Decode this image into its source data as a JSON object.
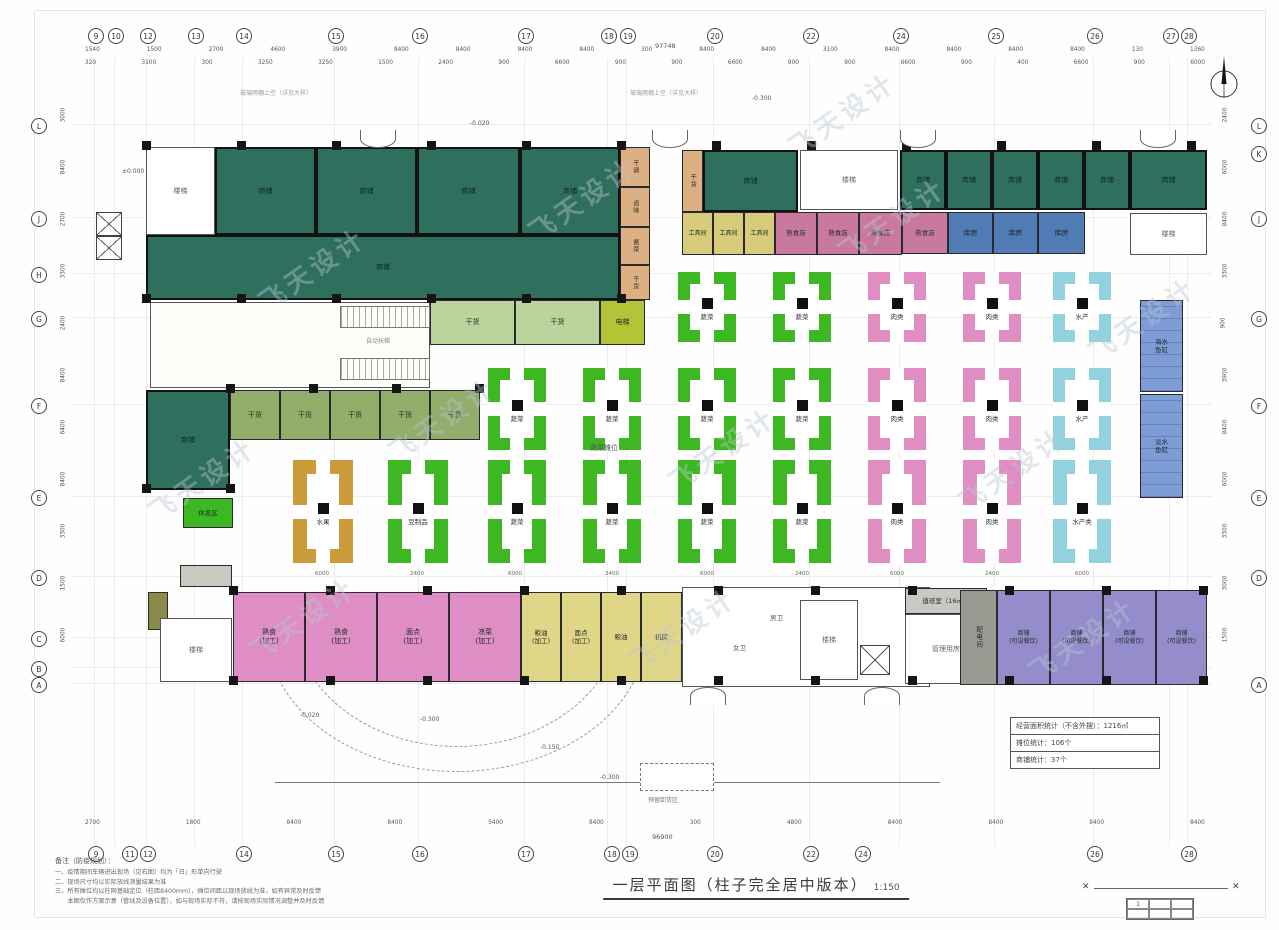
{
  "title": {
    "text": "一层平面图（柱子完全居中版本）",
    "scale": "1:150"
  },
  "watermark": {
    "text": "飞天设计",
    "spots": [
      [
        250,
        250
      ],
      [
        520,
        180
      ],
      [
        830,
        200
      ],
      [
        1080,
        300
      ],
      [
        380,
        400
      ],
      [
        660,
        430
      ],
      [
        950,
        450
      ],
      [
        240,
        600
      ],
      [
        620,
        610
      ],
      [
        1020,
        620
      ],
      [
        780,
        95
      ],
      [
        140,
        460
      ]
    ]
  },
  "notes": {
    "heading": "备注（防疫规划）：",
    "items": [
      "一、疫情期间车辆进出现场（见右图）均为「日」形单向行驶",
      "二、现场尺寸均以实际放线测量结果为准",
      "三、所有摊位均以柱网基础定位（柱距8400mm），摊位间距以现场放线为准，如有异常及时反馈",
      "　　本图仅作方案示意（管线及设备位置），如与现场实际不符，请按现场实际情况调整并及时反馈"
    ]
  },
  "stats_box": {
    "rows": [
      "经营面积统计（不含外摆）：1216㎡",
      "摊位统计：106个",
      "商铺统计：37个"
    ]
  },
  "title_block": {
    "mark": "✕",
    "cells": [
      "1",
      "",
      "",
      "",
      "",
      ""
    ]
  },
  "compass": {
    "label": "北"
  },
  "colors": {
    "teal": "#2e6f5e",
    "green": "#3eb822",
    "pink": "#e08ec2",
    "cyan": "#92d2de",
    "orange": "#cc9b3c",
    "tan": "#ddb083",
    "lgreen": "#b9d49c",
    "mgreen": "#93ad6b",
    "ygreen": "#b3c437",
    "yellowm": "#d6cc7c",
    "yellowb": "#e0d688",
    "pinkm": "#c9799e",
    "pinkb": "#de8ec4",
    "blue": "#4f7cb5",
    "bluestrip": "#7e9cd6",
    "purple": "#958dcb",
    "grey": "#9a9a92",
    "greyl": "#c9c9c2",
    "olive": "#8a8a4a",
    "stair": "#ffffff",
    "atrium": "#fdfdfa",
    "wc": "#ffffff",
    "white": "#ffffff"
  },
  "axes": {
    "top_bubbles": [
      [
        "9",
        88
      ],
      [
        "10",
        108
      ],
      [
        "12",
        140
      ],
      [
        "13",
        188
      ],
      [
        "14",
        236
      ],
      [
        "15",
        328
      ],
      [
        "16",
        412
      ],
      [
        "17",
        518
      ],
      [
        "18",
        601
      ],
      [
        "19",
        620
      ],
      [
        "20",
        707
      ],
      [
        "22",
        803
      ],
      [
        "24",
        893
      ],
      [
        "25",
        988
      ],
      [
        "26",
        1087
      ],
      [
        "27",
        1163
      ],
      [
        "28",
        1181
      ]
    ],
    "bottom_bubbles": [
      [
        "9",
        88
      ],
      [
        "11",
        122
      ],
      [
        "12",
        140
      ],
      [
        "14",
        236
      ],
      [
        "15",
        328
      ],
      [
        "16",
        412
      ],
      [
        "17",
        518
      ],
      [
        "18",
        604
      ],
      [
        "19",
        622
      ],
      [
        "20",
        707
      ],
      [
        "22",
        803
      ],
      [
        "24",
        855
      ],
      [
        "26",
        1087
      ],
      [
        "28",
        1181
      ]
    ],
    "left_letters": [
      [
        "L",
        118
      ],
      [
        "J",
        211
      ],
      [
        "H",
        267
      ],
      [
        "G",
        311
      ],
      [
        "F",
        398
      ],
      [
        "E",
        490
      ],
      [
        "D",
        570
      ],
      [
        "C",
        631
      ],
      [
        "B",
        661
      ],
      [
        "A",
        677
      ]
    ],
    "right_letters": [
      [
        "L",
        118
      ],
      [
        "K",
        146
      ],
      [
        "J",
        211
      ],
      [
        "G",
        311
      ],
      [
        "F",
        398
      ],
      [
        "E",
        490
      ],
      [
        "D",
        570
      ],
      [
        "A",
        677
      ]
    ]
  },
  "dims": {
    "top1": [
      "1540",
      "1500",
      "2700",
      "4600",
      "3900",
      "8400",
      "8400",
      "8400",
      "8400",
      "300",
      "8400",
      "8400",
      "3100",
      "8400",
      "8400",
      "8400",
      "8400",
      "130",
      "1360"
    ],
    "top2": [
      "320",
      "3100",
      "300",
      "3250",
      "3250",
      "1500",
      "2400",
      "900",
      "6600",
      "900",
      "900",
      "6600",
      "900",
      "900",
      "6600",
      "900",
      "400",
      "6600",
      "900",
      "6000"
    ],
    "bottom": [
      "2700",
      "1800",
      "8400",
      "8400",
      "5400",
      "8400",
      "300",
      "4800",
      "8400",
      "8400",
      "8400",
      "8400"
    ],
    "left": [
      "3000",
      "8400",
      "2700",
      "3300",
      "2400",
      "8400",
      "6400",
      "8400",
      "3300",
      "1500",
      "6000"
    ],
    "right": [
      "2400",
      "6000",
      "8400",
      "3300",
      "900",
      "3900",
      "8400",
      "6000",
      "3300",
      "3000",
      "1500"
    ],
    "top_total": "97748",
    "bottom_total": "96900"
  },
  "columns": [
    {
      "y": 145,
      "x0": 146,
      "x1": 1206,
      "step": 95
    },
    {
      "y": 298,
      "x0": 146,
      "x1": 646,
      "step": 95
    },
    {
      "y": 388,
      "x0": 230,
      "x1": 480,
      "step": 83
    },
    {
      "y": 488,
      "x0": 146,
      "x1": 231,
      "step": 84
    },
    {
      "y": 590,
      "x0": 233,
      "x1": 1205,
      "step": 97
    },
    {
      "y": 680,
      "x0": 233,
      "x1": 1205,
      "step": 97
    }
  ],
  "rooms": [
    {
      "x": 146,
      "y": 147,
      "w": 69,
      "h": 88,
      "c": "stair",
      "t": "楼梯"
    },
    {
      "x": 215,
      "y": 147,
      "w": 101,
      "h": 88,
      "c": "teal",
      "t": "商铺"
    },
    {
      "x": 316,
      "y": 147,
      "w": 101,
      "h": 88,
      "c": "teal",
      "t": "商铺"
    },
    {
      "x": 417,
      "y": 147,
      "w": 103,
      "h": 88,
      "c": "teal",
      "t": "商铺"
    },
    {
      "x": 520,
      "y": 147,
      "w": 100,
      "h": 88,
      "c": "teal",
      "t": "商铺"
    },
    {
      "x": 146,
      "y": 235,
      "w": 474,
      "h": 65,
      "c": "teal",
      "t": "商铺"
    },
    {
      "x": 620,
      "y": 147,
      "w": 30,
      "h": 40,
      "c": "tan",
      "t": "干调",
      "v": 1,
      "fs": 6
    },
    {
      "x": 620,
      "y": 187,
      "w": 30,
      "h": 40,
      "c": "tan",
      "t": "卤味",
      "v": 1,
      "fs": 6
    },
    {
      "x": 620,
      "y": 227,
      "w": 30,
      "h": 38,
      "c": "tan",
      "t": "酱菜",
      "v": 1,
      "fs": 6
    },
    {
      "x": 620,
      "y": 265,
      "w": 30,
      "h": 35,
      "c": "tan",
      "t": "干货",
      "v": 1,
      "fs": 6
    },
    {
      "x": 682,
      "y": 150,
      "w": 21,
      "h": 62,
      "c": "tan",
      "t": "干货",
      "v": 1,
      "fs": 6
    },
    {
      "x": 703,
      "y": 150,
      "w": 95,
      "h": 62,
      "c": "teal",
      "t": "商铺"
    },
    {
      "x": 800,
      "y": 150,
      "w": 98,
      "h": 60,
      "c": "stair",
      "t": "楼梯"
    },
    {
      "x": 900,
      "y": 150,
      "w": 46,
      "h": 60,
      "c": "teal",
      "t": "商铺"
    },
    {
      "x": 946,
      "y": 150,
      "w": 46,
      "h": 60,
      "c": "teal",
      "t": "商铺"
    },
    {
      "x": 992,
      "y": 150,
      "w": 46,
      "h": 60,
      "c": "teal",
      "t": "商铺"
    },
    {
      "x": 1038,
      "y": 150,
      "w": 46,
      "h": 60,
      "c": "teal",
      "t": "商铺"
    },
    {
      "x": 1084,
      "y": 150,
      "w": 46,
      "h": 60,
      "c": "teal",
      "t": "商铺"
    },
    {
      "x": 1130,
      "y": 150,
      "w": 77,
      "h": 60,
      "c": "teal",
      "t": "商铺"
    },
    {
      "x": 682,
      "y": 212,
      "w": 31,
      "h": 43,
      "c": "yellowm",
      "t": "工具间",
      "fs": 6
    },
    {
      "x": 713,
      "y": 212,
      "w": 31,
      "h": 43,
      "c": "yellowm",
      "t": "工具间",
      "fs": 6
    },
    {
      "x": 744,
      "y": 212,
      "w": 31,
      "h": 43,
      "c": "yellowm",
      "t": "工具间",
      "fs": 6
    },
    {
      "x": 775,
      "y": 212,
      "w": 42,
      "h": 43,
      "c": "pinkm",
      "t": "熟食店",
      "fs": 6.5
    },
    {
      "x": 817,
      "y": 212,
      "w": 42,
      "h": 43,
      "c": "pinkm",
      "t": "熟食店",
      "fs": 6.5
    },
    {
      "x": 859,
      "y": 212,
      "w": 43,
      "h": 43,
      "c": "pinkm",
      "t": "熟食店",
      "fs": 6.5
    },
    {
      "x": 902,
      "y": 212,
      "w": 46,
      "h": 42,
      "c": "pinkm",
      "t": "熟食店",
      "fs": 6.5
    },
    {
      "x": 948,
      "y": 212,
      "w": 45,
      "h": 42,
      "c": "blue",
      "t": "库房"
    },
    {
      "x": 993,
      "y": 212,
      "w": 45,
      "h": 42,
      "c": "blue",
      "t": "库房"
    },
    {
      "x": 1038,
      "y": 212,
      "w": 47,
      "h": 42,
      "c": "blue",
      "t": "库房"
    },
    {
      "x": 1130,
      "y": 213,
      "w": 77,
      "h": 42,
      "c": "stair",
      "t": "楼梯"
    },
    {
      "x": 150,
      "y": 302,
      "w": 280,
      "h": 86,
      "c": "atrium",
      "t": ""
    },
    {
      "x": 430,
      "y": 300,
      "w": 85,
      "h": 45,
      "c": "lgreen",
      "t": "干货"
    },
    {
      "x": 515,
      "y": 300,
      "w": 85,
      "h": 45,
      "c": "lgreen",
      "t": "干货"
    },
    {
      "x": 600,
      "y": 300,
      "w": 45,
      "h": 45,
      "c": "ygreen",
      "t": "电梯"
    },
    {
      "x": 146,
      "y": 390,
      "w": 84,
      "h": 100,
      "c": "teal",
      "t": "商铺"
    },
    {
      "x": 230,
      "y": 390,
      "w": 50,
      "h": 50,
      "c": "mgreen",
      "t": "干货"
    },
    {
      "x": 280,
      "y": 390,
      "w": 50,
      "h": 50,
      "c": "mgreen",
      "t": "干货"
    },
    {
      "x": 330,
      "y": 390,
      "w": 50,
      "h": 50,
      "c": "mgreen",
      "t": "干货"
    },
    {
      "x": 380,
      "y": 390,
      "w": 50,
      "h": 50,
      "c": "mgreen",
      "t": "干货"
    },
    {
      "x": 430,
      "y": 390,
      "w": 50,
      "h": 50,
      "c": "mgreen",
      "t": "干货"
    },
    {
      "x": 183,
      "y": 498,
      "w": 50,
      "h": 30,
      "c": "green",
      "t": "休息区",
      "fs": 6.5
    },
    {
      "x": 1140,
      "y": 300,
      "w": 43,
      "h": 92,
      "c": "bluestrip",
      "t": "海水\n鱼缸",
      "fs": 6.5
    },
    {
      "x": 1140,
      "y": 394,
      "w": 43,
      "h": 104,
      "c": "bluestrip",
      "t": "淡水\n鱼缸",
      "fs": 6.5
    },
    {
      "x": 180,
      "y": 565,
      "w": 52,
      "h": 22,
      "c": "greyl",
      "t": ""
    },
    {
      "x": 148,
      "y": 592,
      "w": 20,
      "h": 38,
      "c": "olive",
      "t": ""
    },
    {
      "x": 160,
      "y": 618,
      "w": 72,
      "h": 64,
      "c": "stair",
      "t": "楼梯"
    },
    {
      "x": 233,
      "y": 592,
      "w": 72,
      "h": 90,
      "c": "pinkb",
      "t": "熟食\n(加工)"
    },
    {
      "x": 305,
      "y": 592,
      "w": 72,
      "h": 90,
      "c": "pinkb",
      "t": "熟食\n(加工)"
    },
    {
      "x": 377,
      "y": 592,
      "w": 72,
      "h": 90,
      "c": "pinkb",
      "t": "面点\n(加工)"
    },
    {
      "x": 449,
      "y": 592,
      "w": 72,
      "h": 90,
      "c": "pinkb",
      "t": "凉菜\n(加工)"
    },
    {
      "x": 521,
      "y": 592,
      "w": 40,
      "h": 90,
      "c": "yellowb",
      "t": "粮油\n(加工)",
      "fs": 6.5
    },
    {
      "x": 561,
      "y": 592,
      "w": 40,
      "h": 90,
      "c": "yellowb",
      "t": "面点\n(加工)",
      "fs": 6.5
    },
    {
      "x": 601,
      "y": 592,
      "w": 40,
      "h": 90,
      "c": "yellowb",
      "t": "粮油",
      "fs": 6.5
    },
    {
      "x": 641,
      "y": 592,
      "w": 41,
      "h": 90,
      "c": "yellowb",
      "t": "机房",
      "fs": 6.5
    },
    {
      "x": 682,
      "y": 587,
      "w": 248,
      "h": 100,
      "c": "wc",
      "t": ""
    },
    {
      "x": 800,
      "y": 600,
      "w": 58,
      "h": 80,
      "c": "stair",
      "t": "楼梯"
    },
    {
      "x": 905,
      "y": 588,
      "w": 82,
      "h": 26,
      "c": "greyl",
      "t": "值班室（16㎡）",
      "fs": 6.5
    },
    {
      "x": 905,
      "y": 614,
      "w": 82,
      "h": 70,
      "c": "white",
      "t": "管理用房"
    },
    {
      "x": 960,
      "y": 590,
      "w": 37,
      "h": 95,
      "c": "grey",
      "t": "配电间",
      "v": 1,
      "fs": 6.5
    },
    {
      "x": 997,
      "y": 590,
      "w": 53,
      "h": 95,
      "c": "purple",
      "t": "商铺\n(可设餐饮)",
      "fs": 6
    },
    {
      "x": 1050,
      "y": 590,
      "w": 53,
      "h": 95,
      "c": "purple",
      "t": "商铺\n(可设餐饮)",
      "fs": 6
    },
    {
      "x": 1103,
      "y": 590,
      "w": 53,
      "h": 95,
      "c": "purple",
      "t": "商铺\n(可设餐饮)",
      "fs": 6
    },
    {
      "x": 1156,
      "y": 590,
      "w": 51,
      "h": 95,
      "c": "purple",
      "t": "商铺\n(可设餐饮)",
      "fs": 6
    }
  ],
  "stalls": [
    {
      "x": 678,
      "y": 272,
      "w": 58,
      "h": 70,
      "c": "green",
      "t": "蔬菜"
    },
    {
      "x": 773,
      "y": 272,
      "w": 58,
      "h": 70,
      "c": "green",
      "t": "蔬菜"
    },
    {
      "x": 868,
      "y": 272,
      "w": 58,
      "h": 70,
      "c": "pink",
      "t": "肉类"
    },
    {
      "x": 963,
      "y": 272,
      "w": 58,
      "h": 70,
      "c": "pink",
      "t": "肉类"
    },
    {
      "x": 1053,
      "y": 272,
      "w": 58,
      "h": 70,
      "c": "cyan",
      "t": "水产"
    },
    {
      "x": 488,
      "y": 368,
      "w": 58,
      "h": 82,
      "c": "green",
      "t": "蔬菜"
    },
    {
      "x": 583,
      "y": 368,
      "w": 58,
      "h": 82,
      "c": "green",
      "t": "蔬菜"
    },
    {
      "x": 678,
      "y": 368,
      "w": 58,
      "h": 82,
      "c": "green",
      "t": "蔬菜"
    },
    {
      "x": 773,
      "y": 368,
      "w": 58,
      "h": 82,
      "c": "green",
      "t": "蔬菜"
    },
    {
      "x": 868,
      "y": 368,
      "w": 58,
      "h": 82,
      "c": "pink",
      "t": "肉类"
    },
    {
      "x": 963,
      "y": 368,
      "w": 58,
      "h": 82,
      "c": "pink",
      "t": "肉类"
    },
    {
      "x": 1053,
      "y": 368,
      "w": 58,
      "h": 82,
      "c": "cyan",
      "t": "水产"
    },
    {
      "x": 293,
      "y": 460,
      "w": 60,
      "h": 103,
      "c": "orange",
      "t": "水果"
    },
    {
      "x": 388,
      "y": 460,
      "w": 60,
      "h": 103,
      "c": "green",
      "t": "豆制品"
    },
    {
      "x": 488,
      "y": 460,
      "w": 58,
      "h": 103,
      "c": "green",
      "t": "蔬菜"
    },
    {
      "x": 583,
      "y": 460,
      "w": 58,
      "h": 103,
      "c": "green",
      "t": "蔬菜"
    },
    {
      "x": 678,
      "y": 460,
      "w": 58,
      "h": 103,
      "c": "green",
      "t": "蔬菜"
    },
    {
      "x": 773,
      "y": 460,
      "w": 58,
      "h": 103,
      "c": "green",
      "t": "蔬菜"
    },
    {
      "x": 868,
      "y": 460,
      "w": 58,
      "h": 103,
      "c": "pink",
      "t": "肉类"
    },
    {
      "x": 963,
      "y": 460,
      "w": 58,
      "h": 103,
      "c": "pink",
      "t": "肉类"
    },
    {
      "x": 1053,
      "y": 460,
      "w": 58,
      "h": 103,
      "c": "cyan",
      "t": "水产类"
    }
  ],
  "texts": [
    {
      "x": 590,
      "y": 443,
      "t": "蔬菜摊位",
      "s": 7,
      "c": "#555"
    },
    {
      "x": 366,
      "y": 336,
      "t": "自动扶梯",
      "s": 6,
      "c": "#888"
    },
    {
      "x": 733,
      "y": 642,
      "t": "女卫",
      "s": 6.5,
      "c": "#555"
    },
    {
      "x": 770,
      "y": 612,
      "t": "男卫",
      "s": 6.5,
      "c": "#555"
    },
    {
      "x": 752,
      "y": 95,
      "t": "-0.300",
      "s": 6,
      "c": "#555"
    },
    {
      "x": 470,
      "y": 120,
      "t": "-0.020",
      "s": 6,
      "c": "#555"
    },
    {
      "x": 122,
      "y": 168,
      "t": "±0.000",
      "s": 6,
      "c": "#555"
    },
    {
      "x": 300,
      "y": 712,
      "t": "-0.020",
      "s": 6,
      "c": "#555"
    },
    {
      "x": 420,
      "y": 716,
      "t": "-0.300",
      "s": 6,
      "c": "#555"
    },
    {
      "x": 540,
      "y": 744,
      "t": "-0.150",
      "s": 6,
      "c": "#555"
    },
    {
      "x": 600,
      "y": 774,
      "t": "-0.300",
      "s": 6,
      "c": "#555"
    },
    {
      "x": 240,
      "y": 88,
      "t": "玻璃雨棚上空（详见大样）",
      "s": 6,
      "c": "#999"
    },
    {
      "x": 630,
      "y": 88,
      "t": "玻璃雨棚上空（详见大样）",
      "s": 6,
      "c": "#999"
    },
    {
      "x": 648,
      "y": 795,
      "t": "预留卸货区",
      "s": 6,
      "c": "#777"
    },
    {
      "x": 655,
      "y": 42,
      "t": "97748",
      "s": 6.5,
      "c": "#555"
    },
    {
      "x": 652,
      "y": 833,
      "t": "96900",
      "s": 6.5,
      "c": "#555"
    },
    {
      "x": 315,
      "y": 571,
      "t": "6000",
      "s": 5.5,
      "c": "#666"
    },
    {
      "x": 410,
      "y": 571,
      "t": "2400",
      "s": 5.5,
      "c": "#666"
    },
    {
      "x": 508,
      "y": 571,
      "t": "6000",
      "s": 5.5,
      "c": "#666"
    },
    {
      "x": 605,
      "y": 571,
      "t": "2400",
      "s": 5.5,
      "c": "#666"
    },
    {
      "x": 700,
      "y": 571,
      "t": "6000",
      "s": 5.5,
      "c": "#666"
    },
    {
      "x": 795,
      "y": 571,
      "t": "2400",
      "s": 5.5,
      "c": "#666"
    },
    {
      "x": 890,
      "y": 571,
      "t": "6000",
      "s": 5.5,
      "c": "#666"
    },
    {
      "x": 985,
      "y": 571,
      "t": "2400",
      "s": 5.5,
      "c": "#666"
    },
    {
      "x": 1075,
      "y": 571,
      "t": "6000",
      "s": 5.5,
      "c": "#666"
    }
  ],
  "doors": [
    {
      "x": 360,
      "y": 130,
      "w": 34,
      "d": "down"
    },
    {
      "x": 652,
      "y": 130,
      "w": 34,
      "d": "down"
    },
    {
      "x": 900,
      "y": 130,
      "w": 34,
      "d": "down"
    },
    {
      "x": 1140,
      "y": 130,
      "w": 34,
      "d": "down"
    },
    {
      "x": 690,
      "y": 687,
      "w": 34,
      "d": "up"
    },
    {
      "x": 864,
      "y": 687,
      "w": 34,
      "d": "up"
    }
  ]
}
